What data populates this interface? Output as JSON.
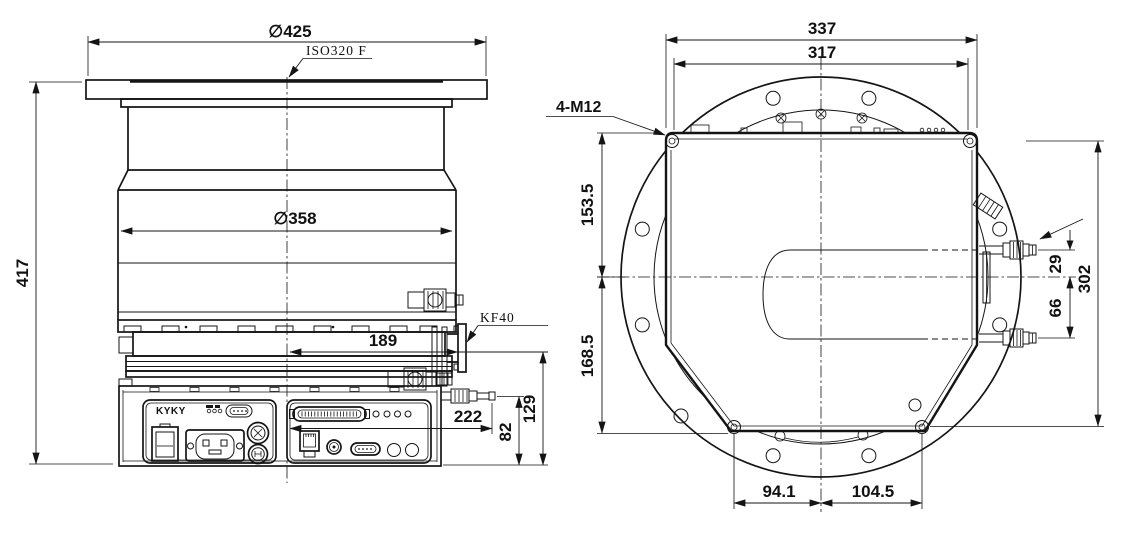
{
  "colors": {
    "line": "#141414",
    "background": "#ffffff"
  },
  "left_view": {
    "brand": "KYKY",
    "dims": {
      "flange_diameter": "∅425",
      "flange_standard": "ISO320 F",
      "overall_height": "417",
      "body_diameter": "∅358",
      "foreline_offset": "189",
      "foreline_port": "KF40",
      "purge_offset": "222",
      "purge_port_height": "82",
      "foreline_port_height": "129"
    }
  },
  "right_view": {
    "dims": {
      "base_width": "337",
      "bolt_spacing": "317",
      "corner_bolts": "4-M12",
      "top_to_center": "153.5",
      "center_to_bottom": "168.5",
      "port_above_center": "29",
      "port_spacing_below": "66",
      "bolt_vertical_span": "302",
      "bottom_bolt_left": "94.1",
      "bottom_bolt_right": "104.5"
    }
  }
}
